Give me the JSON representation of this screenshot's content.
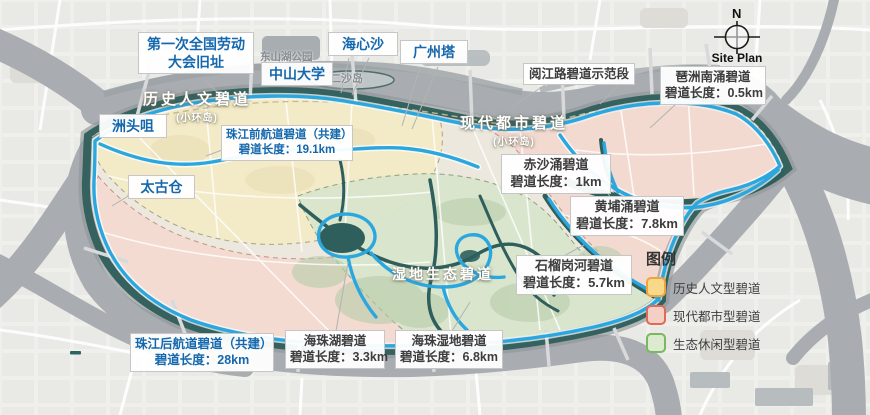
{
  "compass": {
    "north": "N",
    "caption": "Site Plan"
  },
  "legend": {
    "title": "图例",
    "items": [
      {
        "label": "历史人文型碧道",
        "swatch": "background:#f8d98a;border-color:#f0a23c"
      },
      {
        "label": "现代都市型碧道",
        "swatch": "background:#f3cfc5;border-color:#e06a57"
      },
      {
        "label": "生态休闲型碧道",
        "swatch": "background:#dcead0;border-color:#79b760"
      }
    ]
  },
  "zones": {
    "historic": {
      "title": "历史人文碧道",
      "subtitle": "(小环岛)"
    },
    "modern": {
      "title": "现代都市碧道",
      "subtitle": "(小环岛)"
    },
    "eco": {
      "title": "湿地生态碧道"
    }
  },
  "places": {
    "dongshanhu": "东山湖公园",
    "ershadao": "二沙岛"
  },
  "pois": {
    "labor": {
      "line1": "第一次全国劳动",
      "line2": "大会旧址"
    },
    "zhongda": "中山大学",
    "haixinsha": "海心沙",
    "tower": "广州塔",
    "zhoutouzui": "洲头咀",
    "taikoo": "太古仓"
  },
  "routes": {
    "yuejiang": {
      "name": "阅江路碧道示范段"
    },
    "pazhounan": {
      "name": "琶洲南涌碧道",
      "length": "碧道长度：0.5km"
    },
    "qianhangdao": {
      "name": "珠江前航道碧道（共建）",
      "length": "碧道长度：19.1km"
    },
    "chisha": {
      "name": "赤沙涌碧道",
      "length": "碧道长度：1km"
    },
    "huangpuchong": {
      "name": "黄埔涌碧道",
      "length": "碧道长度：7.8km"
    },
    "shiliugang": {
      "name": "石榴岗河碧道",
      "length": "碧道长度：5.7km"
    },
    "houhangdao": {
      "name": "珠江后航道碧道（共建）",
      "length": "碧道长度：28km"
    },
    "haizhuhu": {
      "name": "海珠湖碧道",
      "length": "碧道长度：3.3km"
    },
    "haizhushidi": {
      "name": "海珠湿地碧道",
      "length": "碧道长度：6.8km"
    }
  },
  "colors": {
    "route_blue": "#2ba7e0",
    "shore_teal": "#35625e",
    "creek_teal": "#2e5f5c",
    "river_gray": "#a9adb1",
    "zone_historic": "#f3e9c4",
    "zone_modern": "#f4d8cf",
    "zone_eco": "#d9e5cb",
    "label_blue": "#1568ad",
    "label_dark": "#3d3d3d"
  }
}
